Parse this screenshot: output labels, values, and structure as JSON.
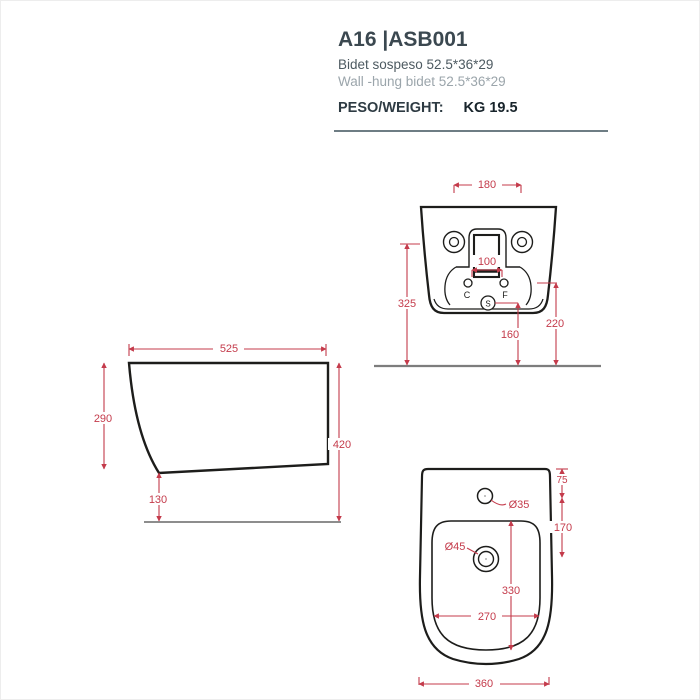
{
  "header": {
    "model_code": "A16 |ASB001",
    "subtitle_it": "Bidet sospeso 52.5*36*29",
    "subtitle_en": "Wall -hung bidet 52.5*36*29",
    "weight_label": "PESO/WEIGHT:",
    "weight_value": "KG 19.5"
  },
  "colors": {
    "dimension_red": "#c43b4b",
    "outline_black": "#1d1d1b",
    "ground_gray": "#7d7d7d",
    "divider": "#6e7d84",
    "title_text": "#3b4850",
    "subtitle_text": "#4d5a61",
    "subtitle_light": "#9ba5ab"
  },
  "views": {
    "rear": {
      "dims": {
        "mount_spacing": "180",
        "inlet_spacing": "100",
        "mount_height": "325",
        "drain_height": "160",
        "inlet_height": "220"
      },
      "labels": {
        "c": "C",
        "f": "F",
        "s": "S"
      }
    },
    "side": {
      "dims": {
        "depth": "525",
        "front_height": "290",
        "total_height": "420",
        "bottom_clearance": "130"
      }
    },
    "top": {
      "dims": {
        "tap_setback": "75",
        "tap_to_drain": "170",
        "tap_hole": "Ø35",
        "drain_hole": "Ø45",
        "basin_length": "330",
        "basin_width": "270",
        "overall_width": "360"
      }
    }
  }
}
